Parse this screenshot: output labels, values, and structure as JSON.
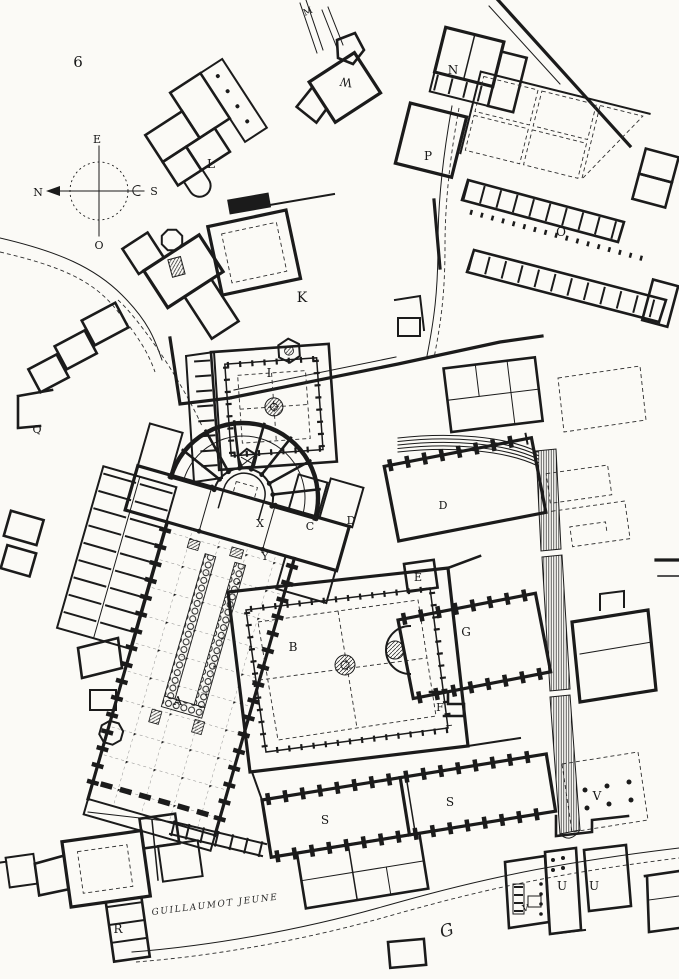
{
  "plate": "6",
  "signature": "GUILLAUMOT JEUNE",
  "engraver_mark": "G",
  "compass": {
    "east": "E",
    "north": "N",
    "south": "S",
    "west": "O"
  },
  "labels": {
    "nave": "A",
    "great_cloister": "B",
    "chapel_c": "C",
    "chapel_d": "D",
    "hall_east": "D",
    "room_e": "E",
    "room_f": "F",
    "hall_g": "G",
    "small_cloister": "I",
    "court_k": "K",
    "building_l": "L",
    "aqueduct_m": "M",
    "building_n": "N",
    "court_o": "O",
    "building_p": "P",
    "enclosure_q": "Q",
    "building_r": "R",
    "hall_s_west": "S",
    "hall_s_east": "S",
    "building_u_west": "U",
    "building_u_east": "U",
    "orchard_v": "V",
    "court_v_small": "V",
    "building_w": "W",
    "choir_x": "X",
    "transept_y": "Y"
  },
  "ink_color": "#1b1b1b",
  "paper_color": "#fbfaf6"
}
